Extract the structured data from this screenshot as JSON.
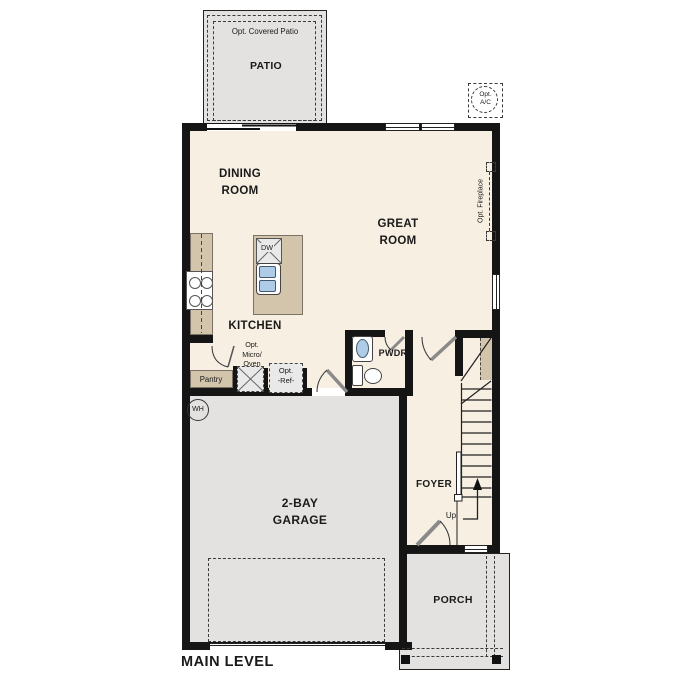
{
  "plan": {
    "title": "MAIN LEVEL",
    "labels": {
      "opt_covered_patio": "Opt. Covered Patio",
      "patio": "PATIO",
      "opt_ac": "Opt.\nA/C",
      "dining_room": "DINING\nROOM",
      "great_room": "GREAT\nROOM",
      "opt_fireplace": "Opt. Fireplace",
      "kitchen": "KITCHEN",
      "dishwasher": "DW",
      "opt_micro_oven": "Opt.\nMicro/\nOven",
      "pantry": "Pantry",
      "opt_ref": "Opt.\n-Ref-",
      "powder_room": "PWDR",
      "water_heater": "WH",
      "garage": "2-BAY\nGARAGE",
      "foyer": "FOYER",
      "up": "Up",
      "porch": "PORCH"
    },
    "colors": {
      "wall": "#151515",
      "interior_floor": "#f6efe2",
      "concrete_slab": "#e3e2e0",
      "cabinetry": "#d2c5ab",
      "plumbing_fixture": "#aecbe8",
      "appliance": "#e9e9e9"
    }
  }
}
